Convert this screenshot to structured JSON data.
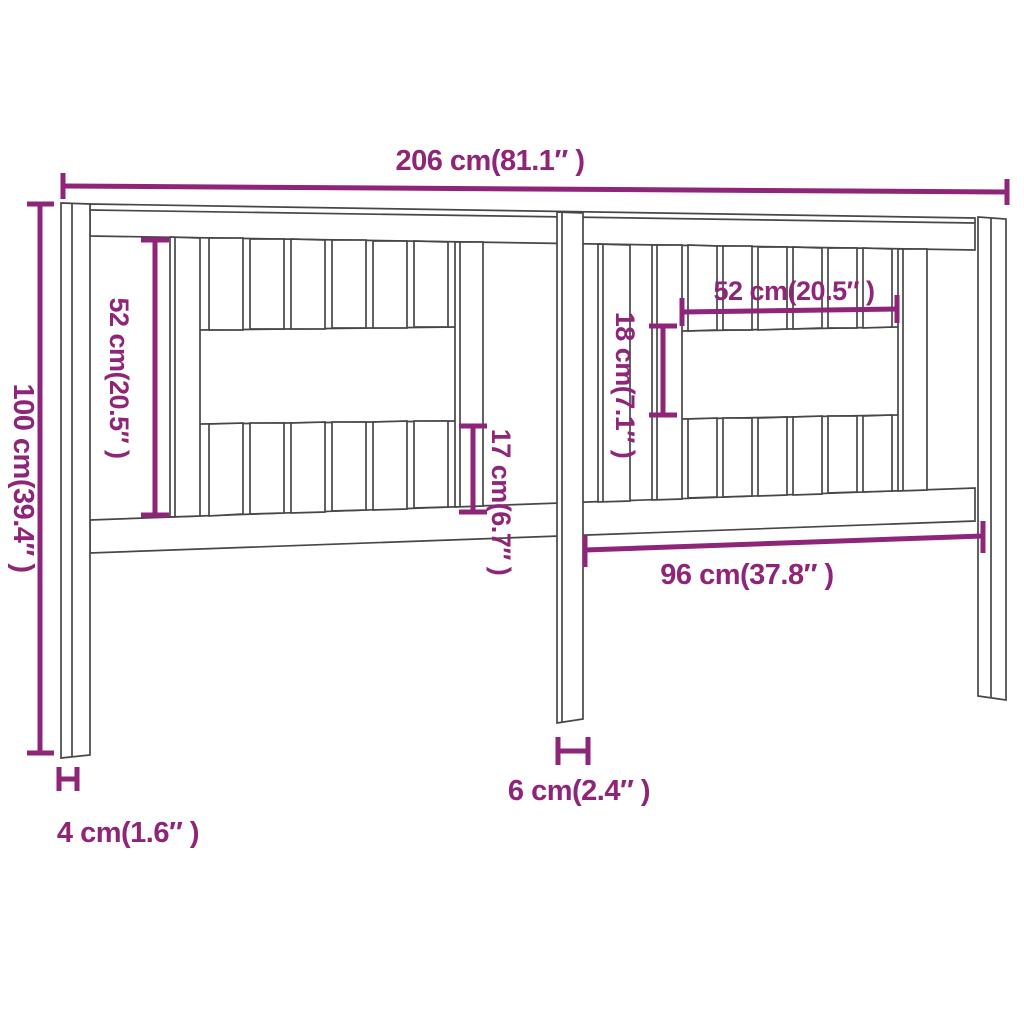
{
  "diagram": {
    "type": "furniture-dimension-drawing",
    "subject": "bed headboard with slats",
    "colors": {
      "dimension_annotation": "#8E2578",
      "drawing_outline": "#474747",
      "background": "#FFFFFF"
    },
    "dimensions": {
      "overall_width": "206 cm(81.1″ )",
      "overall_height": "100 cm(39.4″ )",
      "left_slat_height": "52 cm(20.5″ )",
      "lower_slat_height": "17 cm(6.7″ )",
      "right_opening_width": "52 cm(20.5″ )",
      "right_opening_height": "18 cm(7.1″ )",
      "lower_right_span": "96 cm(37.8″ )",
      "center_leg_width": "6 cm(2.4″ )",
      "side_post_width": "4 cm(1.6″ )"
    }
  }
}
